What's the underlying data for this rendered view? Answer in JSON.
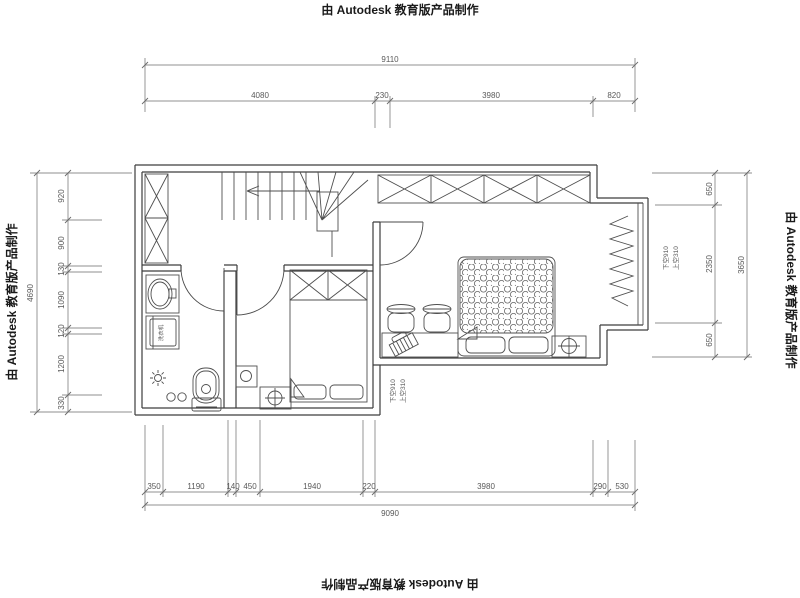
{
  "watermark": {
    "text": "由 Autodesk 教育版产品制作"
  },
  "dims": {
    "top": {
      "overall": "9110",
      "segments": [
        "4080",
        "230",
        "3980",
        "820"
      ]
    },
    "bottom": {
      "overall": "9090",
      "segments": [
        "350",
        "1190",
        "140",
        "450",
        "1940",
        "220",
        "3980",
        "290",
        "530"
      ]
    },
    "left": {
      "overall": "4690",
      "segments": [
        "920",
        "900",
        "130",
        "1090",
        "120",
        "1200",
        "330"
      ]
    },
    "right": {
      "overall": "3650",
      "segments": [
        "650",
        "2350",
        "650"
      ]
    }
  },
  "annotations": {
    "right_window_line1": "上空310",
    "right_window_line2": "下空910",
    "bottom_window_line1": "上空310",
    "bottom_window_line2": "下空910",
    "washing_machine": "洗衣机"
  },
  "colors": {
    "background": "#ffffff",
    "wall": "#3d3d3d",
    "furniture": "#4f4f4f",
    "dimension": "#6b6b6b",
    "text": "#595959",
    "watermark": "#1a1a1a"
  }
}
